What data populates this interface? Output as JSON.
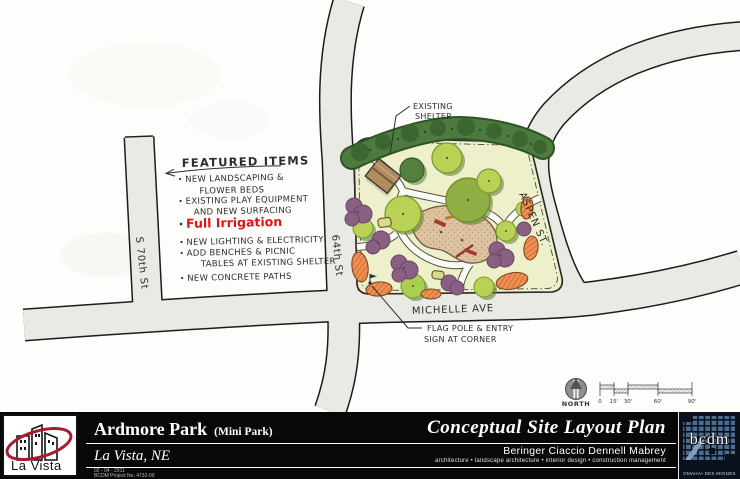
{
  "plan": {
    "featured": {
      "title": "FEATURED ITEMS",
      "items": [
        {
          "lines": [
            "NEW LANDSCAPING &",
            "FLOWER BEDS"
          ]
        },
        {
          "lines": [
            "EXISTING PLAY EQUIPMENT",
            "AND NEW SURFACING"
          ]
        },
        {
          "lines": [
            "Full Irrigation"
          ],
          "highlight": true,
          "color": "#e01218"
        },
        {
          "lines": [
            "NEW LIGHTING & ELECTRICITY"
          ]
        },
        {
          "lines": [
            "ADD BENCHES & PICNIC",
            "TABLES AT EXISTING SHELTER"
          ]
        },
        {
          "lines": [
            "NEW CONCRETE PATHS"
          ]
        }
      ]
    },
    "labels": {
      "existing_shelter": {
        "lines": [
          "EXISTING",
          "SHELTER"
        ]
      },
      "flag_pole": {
        "lines": [
          "FLAG POLE & ENTRY",
          "SIGN AT CORNER"
        ]
      },
      "streets": {
        "s70th": "S 70th St",
        "s64th": "64th St",
        "aspen": "ASPEN ST.",
        "michelle": "MICHELLE AVE"
      }
    },
    "north": {
      "label": "NORTH"
    },
    "scale_bar": {
      "ticks": [
        "0",
        "15'",
        "30'",
        "60'",
        "90'"
      ]
    }
  },
  "titleblock": {
    "park_name": "Ardmore Park",
    "park_type": "(Mini Park)",
    "location": "La Vista, NE",
    "sheet_title": "Conceptual Site Layout Plan",
    "firm_name": "Beringer Ciaccio Dennell Mabrey",
    "firm_services": "architecture  •  landscape architecture  •  interior design  •  construction management",
    "date": "02 - 04 - 2011",
    "project_no": "BCDM Project No. 4732-00",
    "city_logo": {
      "text": "La Vista"
    },
    "firm_logo": {
      "text": "bcdm",
      "subtext": "OMAHA• DES MOINES"
    }
  },
  "colors": {
    "accent_red": "#a51c30",
    "highlight_red": "#e01218",
    "road_fill": "#e9eae3",
    "park_ground": "#eef0cc",
    "tree_dark": "#4d7a3e",
    "tree_light": "#b9d154",
    "shrub_purple": "#8a5f84",
    "flowerbed_orange": "#ef9155",
    "playground_tan": "#dcc29e",
    "titlebar_bg": "#080808",
    "bcdm_navy": "#0b101d",
    "bcdm_blue": "#4c6d8f"
  }
}
